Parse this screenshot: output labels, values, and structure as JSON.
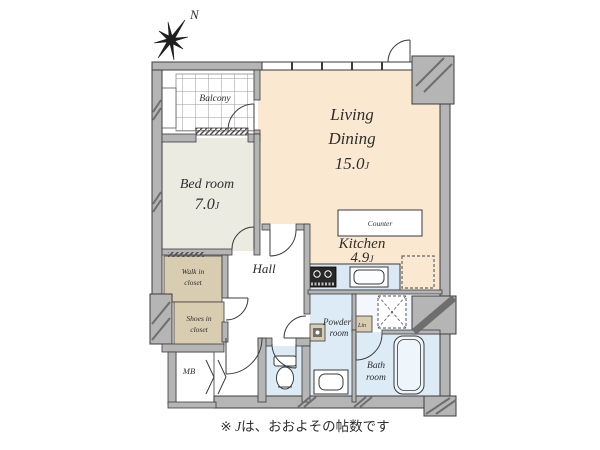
{
  "compass": {
    "north": "N"
  },
  "rooms": {
    "balcony": {
      "label": "Balcony"
    },
    "living_dining": {
      "line1": "Living",
      "line2": "Dining",
      "size": "15.0",
      "unit": "J"
    },
    "bed_room": {
      "label": "Bed room",
      "size": "7.0",
      "unit": "J"
    },
    "kitchen": {
      "label": "Kitchen",
      "size": "4.9",
      "unit": "J"
    },
    "hall": {
      "label": "Hall"
    },
    "counter": {
      "label": "Counter"
    },
    "walk_in_closet": {
      "line1": "Walk in",
      "line2": "closet"
    },
    "shoes_in_closet": {
      "line1": "Shoes in",
      "line2": "closet"
    },
    "powder_room": {
      "line1": "Powder",
      "line2": "room"
    },
    "bath_room": {
      "line1": "Bath",
      "line2": "room"
    },
    "linen": {
      "label": "Lin"
    },
    "meter_box": {
      "label": "MB"
    }
  },
  "footer": {
    "marker": "※ ",
    "unit": "J",
    "note": "は、おおよその帖数です"
  },
  "colors": {
    "floor_living": "#fae8d1",
    "floor_bedroom": "#ebebe2",
    "closet": "#d8ccb1",
    "wet_area": "#dcebf6",
    "wall": "#b5b5b5"
  }
}
